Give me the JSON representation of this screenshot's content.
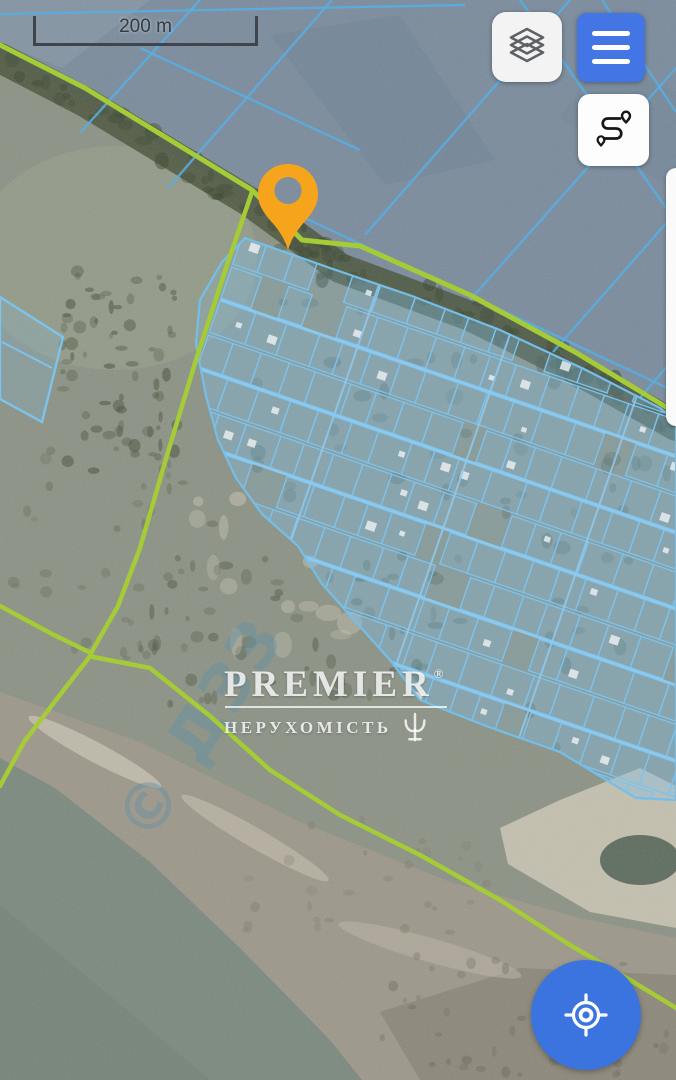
{
  "app": {
    "type": "satellite-map-view"
  },
  "scale_bar": {
    "label": "200 m"
  },
  "controls": {
    "layers_button": {
      "icon": "layers-icon"
    },
    "menu_button": {
      "icon": "hamburger-icon"
    },
    "route_button": {
      "icon": "route-icon"
    },
    "locate_button": {
      "icon": "locate-icon"
    },
    "marker": {
      "icon": "map-pin-icon",
      "color": "#F7A41D"
    },
    "right_edge_panel": {
      "state": "partially-offscreen"
    }
  },
  "icons": {
    "layers-icon": "three stacked diamond outlines",
    "hamburger-icon": "three horizontal bars",
    "route-icon": "s-curved route with two pins",
    "locate-icon": "crosshair target",
    "map-pin-icon": "teardrop pin with hole",
    "trident-logo-icon": "trident emblem"
  },
  "watermark": {
    "brand": "PREMIER",
    "registered": "®",
    "subtitle": "НЕРУХОМІСТЬ"
  },
  "imagery_watermark": {
    "text": "© ДЗЗ",
    "x": 150,
    "y": 845,
    "rot": -57,
    "size": 64,
    "color": "rgba(100,145,165,0.45)"
  },
  "colors": {
    "accent_blue": "#4375E5",
    "fab_blue": "#3C74DF",
    "button_white": "#F3F3F3",
    "marker_orange": "#F7A41D",
    "road_green": "#A5CB37",
    "parcel_blue": "#7CC3EE",
    "field_line_blue": "#57AFE5",
    "icon_gray": "#5E6266",
    "scale_text": "#343B44",
    "watermark_white": "rgba(255,255,255,0.82)"
  },
  "map": {
    "road_color": "#A5CB37",
    "parcel_line": "#7CC3EE",
    "parcel_fill": "rgba(128,196,238,0.2)",
    "field_line_color": "#57AFE5",
    "regions": [
      {
        "kind": "rect",
        "x": 0,
        "y": 0,
        "w": 676,
        "h": 1080,
        "fill": "#8B9284"
      },
      {
        "kind": "poly",
        "pts": [
          [
            0,
            55
          ],
          [
            85,
            100
          ],
          [
            250,
            200
          ],
          [
            340,
            266
          ],
          [
            470,
            314
          ],
          [
            570,
            364
          ],
          [
            676,
            424
          ],
          [
            676,
            0
          ],
          [
            0,
            0
          ]
        ],
        "fill": "#7A8B9C"
      },
      {
        "kind": "ellipse",
        "cx": 115,
        "cy": 258,
        "rx": 142,
        "ry": 112,
        "fill": "#99A28C",
        "op": 0.5
      },
      {
        "kind": "poly",
        "pts": [
          [
            270,
            35
          ],
          [
            400,
            15
          ],
          [
            495,
            160
          ],
          [
            385,
            185
          ]
        ],
        "fill": "#64798D",
        "op": 0.3
      },
      {
        "kind": "poly",
        "pts": [
          [
            0,
            0
          ],
          [
            150,
            0
          ],
          [
            62,
            68
          ],
          [
            0,
            42
          ]
        ],
        "fill": "#93A3B0",
        "op": 0.4
      },
      {
        "kind": "poly",
        "pts": [
          [
            560,
            118
          ],
          [
            600,
            58
          ],
          [
            676,
            92
          ],
          [
            676,
            192
          ]
        ],
        "fill": "#6E8396",
        "op": 0.35
      },
      {
        "kind": "poly",
        "pts": [
          [
            0,
            692
          ],
          [
            140,
            742
          ],
          [
            300,
            822
          ],
          [
            450,
            882
          ],
          [
            580,
            918
          ],
          [
            676,
            938
          ],
          [
            676,
            1080
          ],
          [
            0,
            1080
          ]
        ],
        "fill": "#9D978A"
      },
      {
        "kind": "poly",
        "pts": [
          [
            380,
            1012
          ],
          [
            520,
            968
          ],
          [
            676,
            975
          ],
          [
            676,
            1080
          ],
          [
            420,
            1080
          ]
        ],
        "fill": "#7E7A6C",
        "op": 0.55
      },
      {
        "kind": "poly",
        "pts": [
          [
            500,
            828
          ],
          [
            560,
            800
          ],
          [
            640,
            768
          ],
          [
            676,
            786
          ],
          [
            676,
            928
          ],
          [
            590,
            912
          ],
          [
            508,
            864
          ]
        ],
        "fill": "#D2CCBA",
        "op": 0.8
      },
      {
        "kind": "ellipse",
        "cx": 640,
        "cy": 860,
        "rx": 40,
        "ry": 25,
        "fill": "#44564A",
        "op": 0.8
      },
      {
        "kind": "ellipse",
        "cx": 95,
        "cy": 752,
        "rx": 75,
        "ry": 10,
        "rot": 28,
        "fill": "#CFCBBB",
        "op": 0.65
      },
      {
        "kind": "ellipse",
        "cx": 255,
        "cy": 838,
        "rx": 85,
        "ry": 10,
        "rot": 30,
        "fill": "#C8C3B2",
        "op": 0.55
      },
      {
        "kind": "ellipse",
        "cx": 430,
        "cy": 950,
        "rx": 95,
        "ry": 12,
        "rot": 16,
        "fill": "#BDB8A8",
        "op": 0.5
      },
      {
        "kind": "poly",
        "pts": [
          [
            0,
            758
          ],
          [
            55,
            788
          ],
          [
            150,
            862
          ],
          [
            240,
            948
          ],
          [
            330,
            1040
          ],
          [
            362,
            1080
          ],
          [
            0,
            1080
          ]
        ],
        "fill": "#7B897E"
      },
      {
        "kind": "poly",
        "pts": [
          [
            0,
            905
          ],
          [
            115,
            1000
          ],
          [
            210,
            1080
          ],
          [
            0,
            1080
          ]
        ],
        "fill": "#6F7F74",
        "op": 0.5
      }
    ],
    "tree_band": {
      "pts": [
        [
          0,
          58
        ],
        [
          85,
          102
        ],
        [
          250,
          202
        ],
        [
          340,
          268
        ],
        [
          470,
          316
        ],
        [
          570,
          366
        ],
        [
          676,
          426
        ]
      ],
      "color": "#49523A",
      "width": 30,
      "op": 0.85
    },
    "band_speckles": {
      "n": 80,
      "jitter": 15,
      "rmin": 3,
      "rmax": 9,
      "color": "#39452E",
      "op": 0.55
    },
    "speckle_zones": [
      {
        "x": 62,
        "y": 270,
        "w": 118,
        "h": 205,
        "n": 70,
        "rmin": 2,
        "rmax": 7,
        "color": "#49553F",
        "op": 0.6
      },
      {
        "x": 140,
        "y": 555,
        "w": 300,
        "h": 150,
        "n": 55,
        "rmin": 2,
        "rmax": 8,
        "color": "#4A5540",
        "op": 0.5
      },
      {
        "x": 0,
        "y": 430,
        "w": 220,
        "h": 235,
        "n": 35,
        "rmin": 2,
        "rmax": 6,
        "color": "#566049",
        "op": 0.4
      },
      {
        "x": 185,
        "y": 495,
        "w": 165,
        "h": 165,
        "n": 14,
        "rmin": 4,
        "rmax": 14,
        "color": "#CCC7B6",
        "op": 0.55
      },
      {
        "x": 380,
        "y": 955,
        "w": 290,
        "h": 120,
        "n": 45,
        "rmin": 2,
        "rmax": 6,
        "color": "#69675A",
        "op": 0.5
      },
      {
        "x": 230,
        "y": 815,
        "w": 260,
        "h": 120,
        "n": 28,
        "rmin": 2,
        "rmax": 6,
        "color": "#807C6B",
        "op": 0.5
      },
      {
        "x": 210,
        "y": 270,
        "w": 460,
        "h": 520,
        "n": 85,
        "rmin": 3,
        "rmax": 9,
        "color": "#49584A",
        "op": 0.4,
        "clip": true
      }
    ],
    "field_lines": [
      [
        [
          80,
          133
        ],
        [
          200,
          0
        ]
      ],
      [
        [
          168,
          188
        ],
        [
          332,
          0
        ]
      ],
      [
        [
          365,
          235
        ],
        [
          570,
          0
        ]
      ],
      [
        [
          470,
          300
        ],
        [
          676,
          68
        ]
      ],
      [
        [
          553,
          352
        ],
        [
          676,
          212
        ]
      ],
      [
        [
          640,
          398
        ],
        [
          676,
          356
        ]
      ],
      [
        [
          520,
          0
        ],
        [
          676,
          222
        ]
      ],
      [
        [
          602,
          0
        ],
        [
          676,
          112
        ]
      ],
      [
        [
          0,
          14
        ],
        [
          465,
          5
        ]
      ],
      [
        [
          140,
          48
        ],
        [
          360,
          150
        ]
      ],
      [
        [
          258,
          196
        ],
        [
          676,
          392
        ]
      ]
    ],
    "settlement": {
      "pts": [
        [
          245,
          238
        ],
        [
          330,
          268
        ],
        [
          412,
          296
        ],
        [
          500,
          330
        ],
        [
          586,
          370
        ],
        [
          660,
          408
        ],
        [
          676,
          420
        ],
        [
          676,
          800
        ],
        [
          636,
          798
        ],
        [
          560,
          752
        ],
        [
          486,
          726
        ],
        [
          420,
          700
        ],
        [
          390,
          660
        ],
        [
          356,
          622
        ],
        [
          322,
          584
        ],
        [
          298,
          546
        ],
        [
          262,
          514
        ],
        [
          236,
          478
        ],
        [
          218,
          440
        ],
        [
          206,
          396
        ],
        [
          196,
          344
        ],
        [
          200,
          300
        ],
        [
          222,
          262
        ]
      ],
      "wash": "rgba(126,192,235,0.2)",
      "border": "#74BFEA"
    },
    "grid": {
      "angle": 19,
      "ox": 250,
      "oy": 260,
      "x0": 235,
      "x1": 835,
      "y0": 235,
      "y1": 645,
      "rowH": 36,
      "cellMin": 24,
      "cellVar": 14,
      "skip": 0.08,
      "houseP": 0.3,
      "street": "#8FCBEF",
      "cross_streets": [
        380,
        520,
        660
      ],
      "house_fill": "#E9EDF0"
    },
    "outlier": {
      "pts": [
        [
          0,
          297
        ],
        [
          63,
          337
        ],
        [
          42,
          422
        ],
        [
          0,
          399
        ]
      ],
      "inner": [
        [
          [
            2,
            342
          ],
          [
            52,
            368
          ]
        ]
      ]
    },
    "roads": [
      {
        "w": 5,
        "pts": [
          [
            0,
            45
          ],
          [
            85,
            88
          ],
          [
            252,
            190
          ],
          [
            302,
            240
          ],
          [
            360,
            246
          ],
          [
            470,
            295
          ],
          [
            575,
            352
          ],
          [
            676,
            413
          ]
        ]
      },
      {
        "w": 4.5,
        "pts": [
          [
            252,
            192
          ],
          [
            228,
            262
          ],
          [
            196,
            360
          ],
          [
            168,
            452
          ],
          [
            140,
            548
          ],
          [
            118,
            606
          ],
          [
            91,
            653
          ]
        ]
      },
      {
        "w": 4.5,
        "pts": [
          [
            91,
            653
          ],
          [
            52,
            634
          ],
          [
            0,
            606
          ]
        ]
      },
      {
        "w": 4.5,
        "pts": [
          [
            91,
            655
          ],
          [
            56,
            700
          ],
          [
            24,
            742
          ],
          [
            0,
            786
          ]
        ]
      },
      {
        "w": 4.5,
        "pts": [
          [
            93,
            657
          ],
          [
            150,
            668
          ],
          [
            210,
            716
          ],
          [
            270,
            770
          ],
          [
            340,
            815
          ],
          [
            420,
            855
          ],
          [
            500,
            900
          ],
          [
            570,
            945
          ],
          [
            630,
            980
          ],
          [
            676,
            1008
          ]
        ]
      }
    ]
  }
}
